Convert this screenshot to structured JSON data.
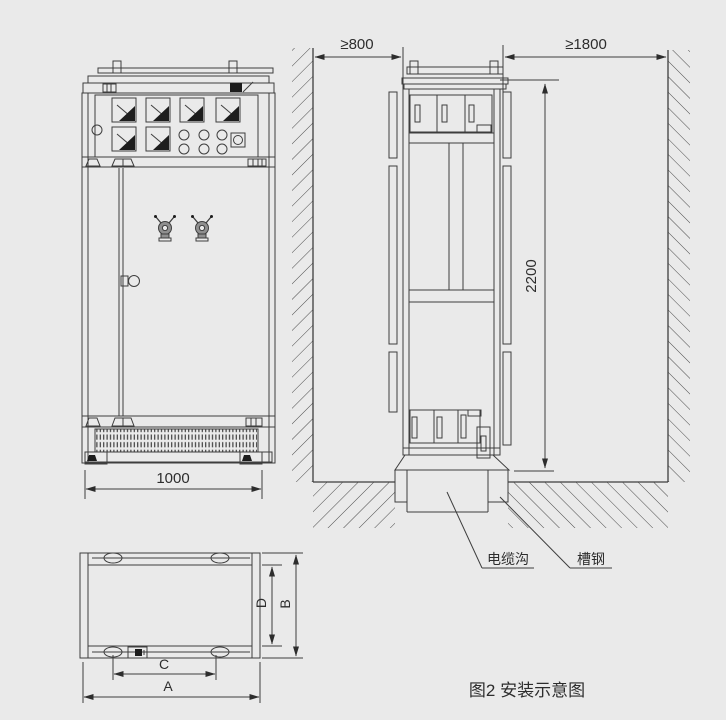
{
  "figure": {
    "caption": "图2 安装示意图",
    "background_color": "#eaeaea",
    "line_color": "#3e3e3e"
  },
  "front_view": {
    "dim_width": "1000"
  },
  "side_view": {
    "dim_left_clearance": "≥800",
    "dim_right_clearance": "≥1800",
    "dim_height": "2200",
    "labels": {
      "cable_trench": "电缆沟",
      "channel_steel": "槽钢"
    }
  },
  "top_view": {
    "dim_overall_width": "A",
    "dim_overall_depth": "B",
    "dim_hole_spacing_width": "C",
    "dim_hole_spacing_depth": "D"
  }
}
